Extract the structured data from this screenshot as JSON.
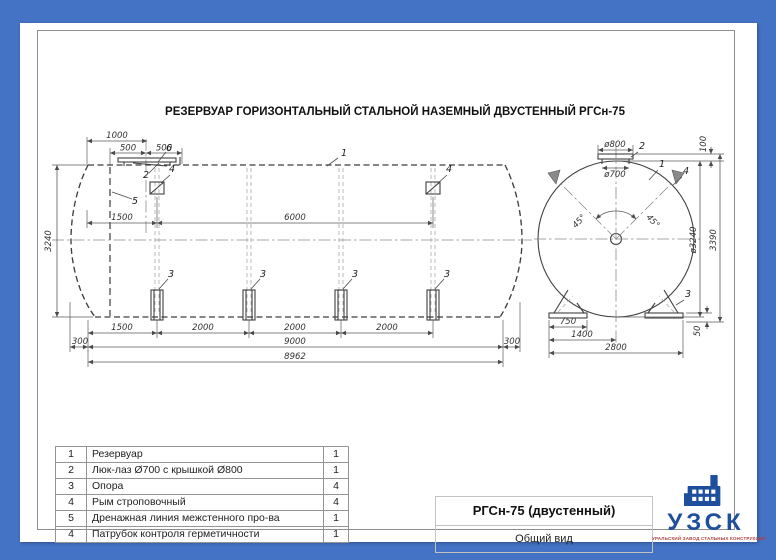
{
  "drawing_title": "РЕЗЕРВУАР ГОРИЗОНТАЛЬНЫЙ СТАЛЬНОЙ НАЗЕМНЫЙ ДВУСТЕННЫЙ РГСн-75",
  "colors": {
    "frame_blue": "#4472C4",
    "logo_blue": "#1d4f9e",
    "caption_red": "#b04040",
    "line": "#3f3f3f"
  },
  "side_view": {
    "dim_1000": "1000",
    "dim_500_left": "500",
    "dim_500_right": "500",
    "dim_1500_top": "1500",
    "dim_6000": "6000",
    "dim_3240": "3240",
    "dim_1500_bottom": "1500",
    "dim_2000_1": "2000",
    "dim_2000_2": "2000",
    "dim_2000_3": "2000",
    "dim_300_left": "300",
    "dim_9000": "9000",
    "dim_300_right": "300",
    "dim_8962": "8962",
    "callout_tank": "1",
    "callout_manhole": "2",
    "callout_support": "3",
    "callout_lug": "4",
    "callout_drain": "5",
    "callout_nozzle": "6"
  },
  "end_view": {
    "dim_d800": "ø800",
    "dim_d700": "ø700",
    "dim_100": "100",
    "dim_45_left": "45°",
    "dim_45_right": "45°",
    "dim_d3240": "ø3240",
    "dim_3390": "3390",
    "dim_750": "750",
    "dim_1400": "1400",
    "dim_2800": "2800",
    "dim_50": "50",
    "callout_tank": "1",
    "callout_manhole": "2",
    "callout_support": "3",
    "callout_lug": "4"
  },
  "parts_table": {
    "rows": [
      {
        "num": "1",
        "name": "Резервуар",
        "qty": "1"
      },
      {
        "num": "2",
        "name": "Люк-лаз Ø700 с крышкой Ø800",
        "qty": "1"
      },
      {
        "num": "3",
        "name": "Опора",
        "qty": "4"
      },
      {
        "num": "4",
        "name": "Рым строповочный",
        "qty": "4"
      },
      {
        "num": "5",
        "name": "Дренажная линия межстенного про-ва",
        "qty": "1"
      },
      {
        "num": "4",
        "name": "Патрубок контроля герметичности",
        "qty": "1"
      }
    ]
  },
  "title_block": {
    "model": "РГСн-75 (двустенный)",
    "view_name": "Общий вид"
  },
  "logo": {
    "abbr": "УЗСК",
    "caption": "УРАЛЬСКИЙ ЗАВОД СТАЛЬНЫХ КОНСТРУКЦИЙ"
  }
}
